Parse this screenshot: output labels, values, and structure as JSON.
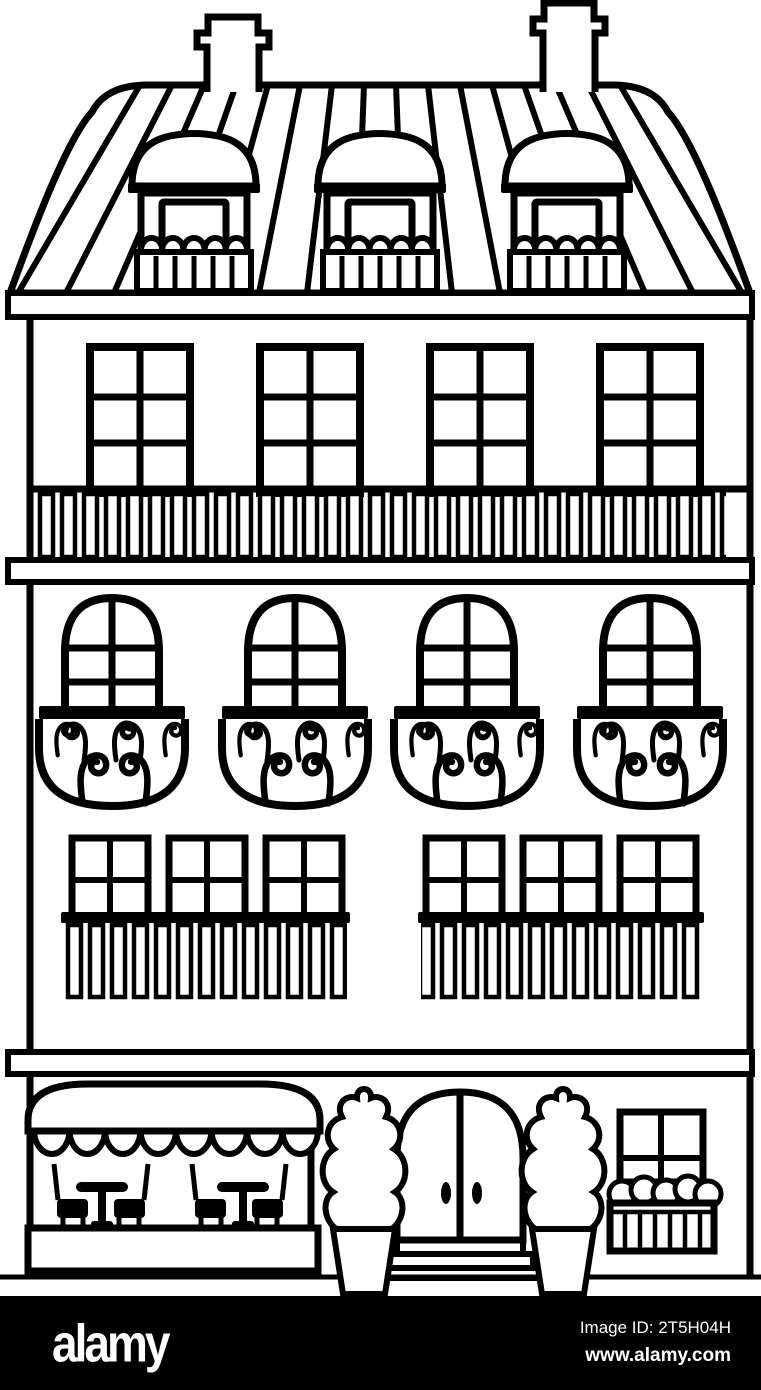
{
  "image": {
    "style": "black-and-white line-art coloring page",
    "subject": "Parisian townhouse with mansard roof, cafe terrace and arched entrance"
  },
  "colors": {
    "line": "#000000",
    "background": "#ffffff",
    "bar_background": "#000000",
    "bar_text": "#ffffff"
  },
  "scene": {
    "roof": {
      "chimneys": 2,
      "dormer_windows": 3,
      "striped": true
    },
    "third_floor": {
      "windows": 4,
      "panes_per_window": 6,
      "balcony": "full-width balustrade"
    },
    "second_floor": {
      "arched_windows": 4,
      "ornate_round_balconies": 4
    },
    "first_floor": {
      "windows": 6,
      "bar_balconies": 2
    },
    "ground_floor": {
      "cafe_awning": "scalloped awning",
      "tables": 2,
      "chairs": 4,
      "topiary_trees_in_pots": 2,
      "entrance": "arched double door with handles and 3 steps",
      "shop_window": 1,
      "flower_box": 1
    }
  },
  "watermark": {
    "logo": "alamy",
    "image_id": "Image ID: 2T5H04H",
    "url": "www.alamy.com"
  }
}
